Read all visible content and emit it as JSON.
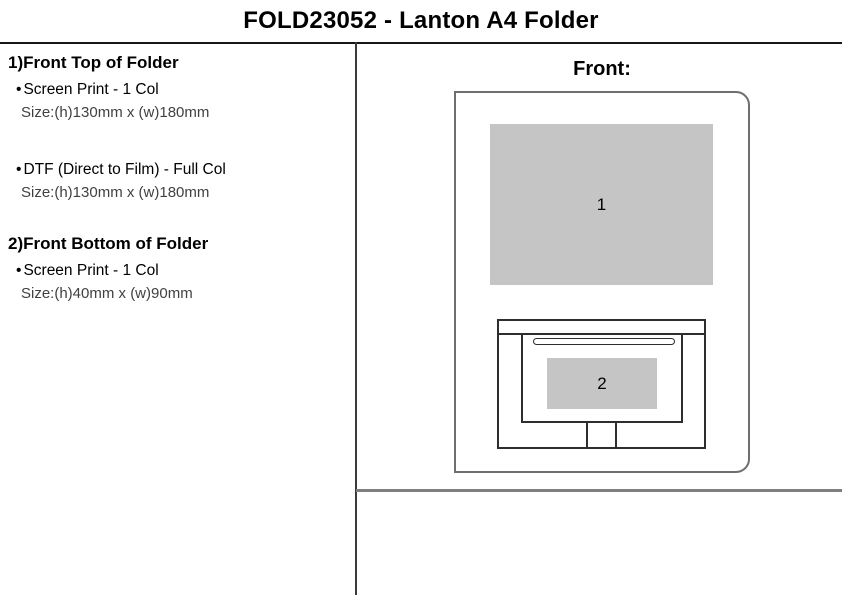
{
  "page": {
    "title": "FOLD23052 - Lanton A4 Folder"
  },
  "specs": {
    "bullet": "•",
    "sections": [
      {
        "heading": "1)Front Top of Folder",
        "options": [
          {
            "method": "Screen Print - 1 Col",
            "size": "Size:(h)130mm x (w)180mm"
          },
          {
            "method": "DTF (Direct to Film) - Full Col",
            "size": "Size:(h)130mm x (w)180mm"
          }
        ]
      },
      {
        "heading": "2)Front Bottom of Folder",
        "options": [
          {
            "method": "Screen Print - 1 Col",
            "size": "Size:(h)40mm x (w)90mm"
          }
        ]
      }
    ]
  },
  "diagram": {
    "view_label": "Front:",
    "print_areas": [
      {
        "label": "1"
      },
      {
        "label": "2"
      }
    ],
    "colors": {
      "print_area_fill": "#c5c5c5",
      "folder_outline": "#6e6e6e",
      "pocket_outline": "#2e2e2e",
      "divider": "#3a3a3a",
      "bottom_rule": "#7f7f7f"
    }
  }
}
